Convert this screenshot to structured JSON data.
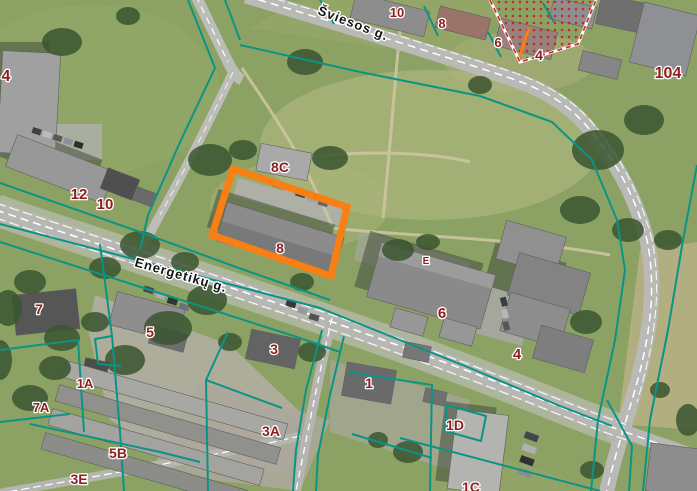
{
  "map": {
    "type": "cadastral-gis-viewer-aerial-basemap",
    "streets": [
      {
        "id": "sviesos",
        "name": "Šviesos g."
      },
      {
        "id": "energetiku",
        "name": "Energetikų g."
      }
    ],
    "highlight": {
      "selected_parcel_address": "8",
      "outline_color": "#F97E14"
    },
    "colors": {
      "parcel_boundary": "#0B9486",
      "highlight_outline": "#F97E14",
      "address_text": "#8F1D1D",
      "restricted_zone_dots": "#CC2222",
      "street_text": "#141414"
    },
    "address_labels": [
      {
        "id": "a10-top",
        "text": "10"
      },
      {
        "id": "a8-top",
        "text": "8"
      },
      {
        "id": "a6-top",
        "text": "6"
      },
      {
        "id": "a4-top",
        "text": "4"
      },
      {
        "id": "a104",
        "text": "104"
      },
      {
        "id": "a4-left",
        "text": "4"
      },
      {
        "id": "a12",
        "text": "12"
      },
      {
        "id": "a10-left",
        "text": "10"
      },
      {
        "id": "a8C",
        "text": "8C"
      },
      {
        "id": "a8-sel",
        "text": "8"
      },
      {
        "id": "aE",
        "text": "E"
      },
      {
        "id": "a6-mid",
        "text": "6"
      },
      {
        "id": "a4-mid",
        "text": "4"
      },
      {
        "id": "a7",
        "text": "7"
      },
      {
        "id": "a5",
        "text": "5"
      },
      {
        "id": "a1A",
        "text": "1A"
      },
      {
        "id": "a7A",
        "text": "7A"
      },
      {
        "id": "a5B",
        "text": "5B"
      },
      {
        "id": "a3E",
        "text": "3E"
      },
      {
        "id": "a3",
        "text": "3"
      },
      {
        "id": "a3A",
        "text": "3A"
      },
      {
        "id": "a1",
        "text": "1"
      },
      {
        "id": "a1D",
        "text": "1D"
      },
      {
        "id": "a1C",
        "text": "1C"
      }
    ]
  }
}
